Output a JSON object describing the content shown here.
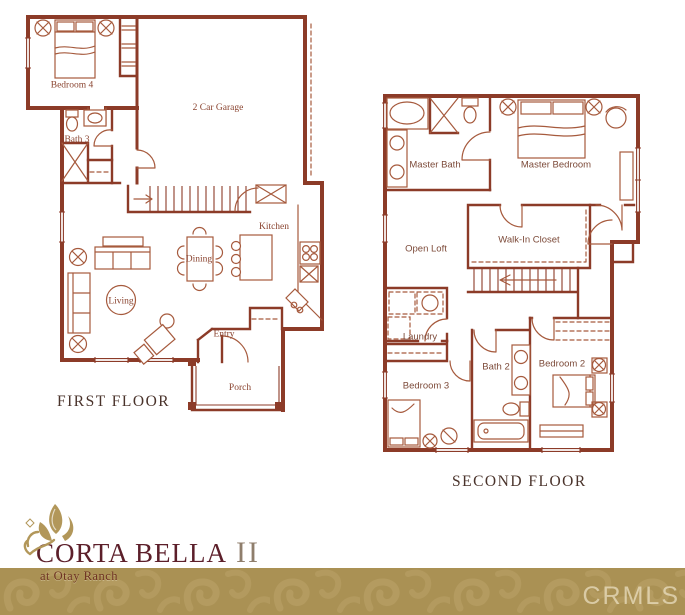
{
  "first_floor": {
    "title": "FIRST FLOOR",
    "rooms": {
      "bedroom4": "Bedroom 4",
      "bath3": "Bath 3",
      "garage": "2 Car Garage",
      "kitchen": "Kitchen",
      "dining": "Dining",
      "living": "Living",
      "entry": "Entry",
      "porch": "Porch"
    }
  },
  "second_floor": {
    "title": "SECOND FLOOR",
    "rooms": {
      "master_bath": "Master Bath",
      "master_bedroom": "Master Bedroom",
      "open_loft": "Open Loft",
      "walk_in_closet": "Walk-In Closet",
      "laundry": "Laundry",
      "bath2": "Bath 2",
      "bedroom3": "Bedroom 3",
      "bedroom2": "Bedroom 2"
    }
  },
  "branding": {
    "name": "CORTA BELLA",
    "name_suffix": "II",
    "tagline": "at Otay Ranch"
  },
  "watermark": "CRMLS",
  "colors": {
    "wall": "#8c3b28",
    "furniture": "#a65a3d",
    "room_label": "#8a4430",
    "floor_title": "#4a332b",
    "brand_text": "#5c1f2a",
    "brand_suffix": "#8f7e6c",
    "band_gold": "#aa9154",
    "band_pattern": "#bca469"
  }
}
